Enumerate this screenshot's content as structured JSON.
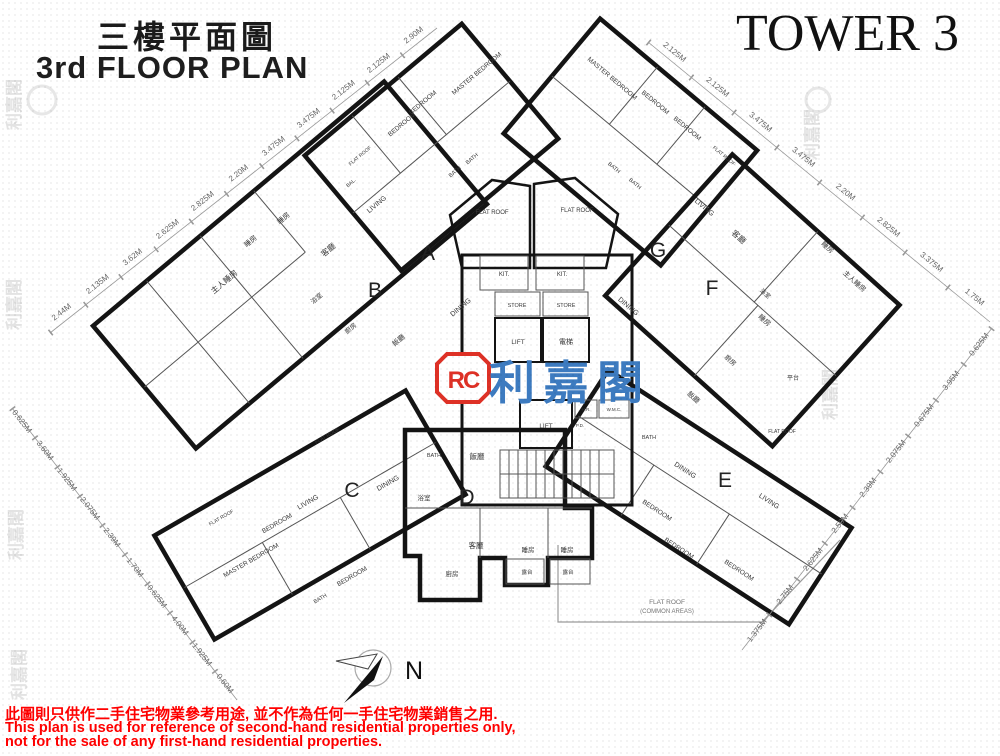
{
  "header": {
    "title_zh": "三樓平面圖",
    "title_en": "3rd FLOOR PLAN",
    "tower": "TOWER 3"
  },
  "logo": {
    "monogram": "RC",
    "brand": "利嘉閣"
  },
  "compass": {
    "label": "N"
  },
  "disclaimer": {
    "zh": "此圖則只供作二手住宅物業參考用途, 並不作為任何一手住宅物業銷售之用.",
    "en1": "This plan is used for reference of second-hand residential properties only,",
    "en2": " not for the sale of any first-hand residential properties."
  },
  "plan": {
    "units": [
      {
        "id": "A",
        "rooms": [
          "MASTER BEDROOM",
          "BEDROOM",
          "BEDROOM",
          "BATH",
          "BATH",
          "LIVING",
          "DINING",
          "KIT.",
          "BAL.",
          "FLAT ROOF"
        ]
      },
      {
        "id": "B",
        "rooms": [
          "主人睡房",
          "睡房",
          "睡房",
          "客廳",
          "浴室",
          "廚房",
          "飯廳"
        ]
      },
      {
        "id": "C",
        "rooms": [
          "FLAT ROOF",
          "BEDROOM",
          "MASTER BEDROOM",
          "BEDROOM",
          "LIVING",
          "DINING",
          "BATH",
          "BATH",
          "FLAT ROOF"
        ]
      },
      {
        "id": "D",
        "rooms": [
          "飯廳",
          "客廳",
          "睡房",
          "睡房",
          "露台",
          "露台",
          "廚房",
          "浴室"
        ]
      },
      {
        "id": "E",
        "rooms": [
          "DINING",
          "LIVING",
          "BEDROOM",
          "BEDROOM",
          "BEDROOM",
          "BATH",
          "FLAT ROOF"
        ]
      },
      {
        "id": "F",
        "rooms": [
          "客廳",
          "睡房",
          "主人睡房",
          "浴室",
          "睡房",
          "廚房",
          "飯廳",
          "平台"
        ]
      },
      {
        "id": "G",
        "rooms": [
          "MASTER BEDROOM",
          "BEDROOM",
          "BEDROOM",
          "BATH",
          "BATH",
          "LIVING",
          "DINING",
          "KIT.",
          "FLAT ROOF"
        ]
      }
    ],
    "core": {
      "store_left": "STORE",
      "store_right": "STORE",
      "lift_upper": "LIFT",
      "lift_zh": "電梯",
      "lift_lower": "LIFT",
      "hr": "H.R.",
      "wmc": "W.M.C.",
      "pd": "P.D.",
      "flat_roof_left": "FLAT ROOF",
      "flat_roof_right": "FLAT ROOF",
      "common_line1": "FLAT ROOF",
      "common_line2": "(COMMON AREAS)"
    },
    "dimensions": {
      "top_left": [
        "2.44M",
        "2.135M",
        "3.62M",
        "2.625M",
        "2.825M",
        "2.20M",
        "3.475M",
        "3.475M",
        "2.125M",
        "2.125M",
        "2.90M"
      ],
      "top_right": [
        "2.125M",
        "2.125M",
        "3.475M",
        "3.475M",
        "2.20M",
        "2.825M",
        "3.375M",
        "1.75M"
      ],
      "right": [
        "0.625M",
        "3.95M",
        "0.675M",
        "2.075M",
        "2.39M",
        "2.50M",
        "2.625M",
        "2.75M",
        "1.375M"
      ],
      "left": [
        "0.625M",
        "3.60M",
        "1.925M",
        "2.075M",
        "2.39M",
        "1.70M",
        "0.625M",
        "4.00M",
        "1.925M",
        "0.60M"
      ]
    }
  },
  "colors": {
    "unit_cream": "#F5EDBE",
    "unit_yellow": "#F1CF68",
    "unit_orange": "#F3C368",
    "logo_red": "#DE3126",
    "logo_blue": "#3D7BC0",
    "disclaimer_red": "#FF0000"
  }
}
